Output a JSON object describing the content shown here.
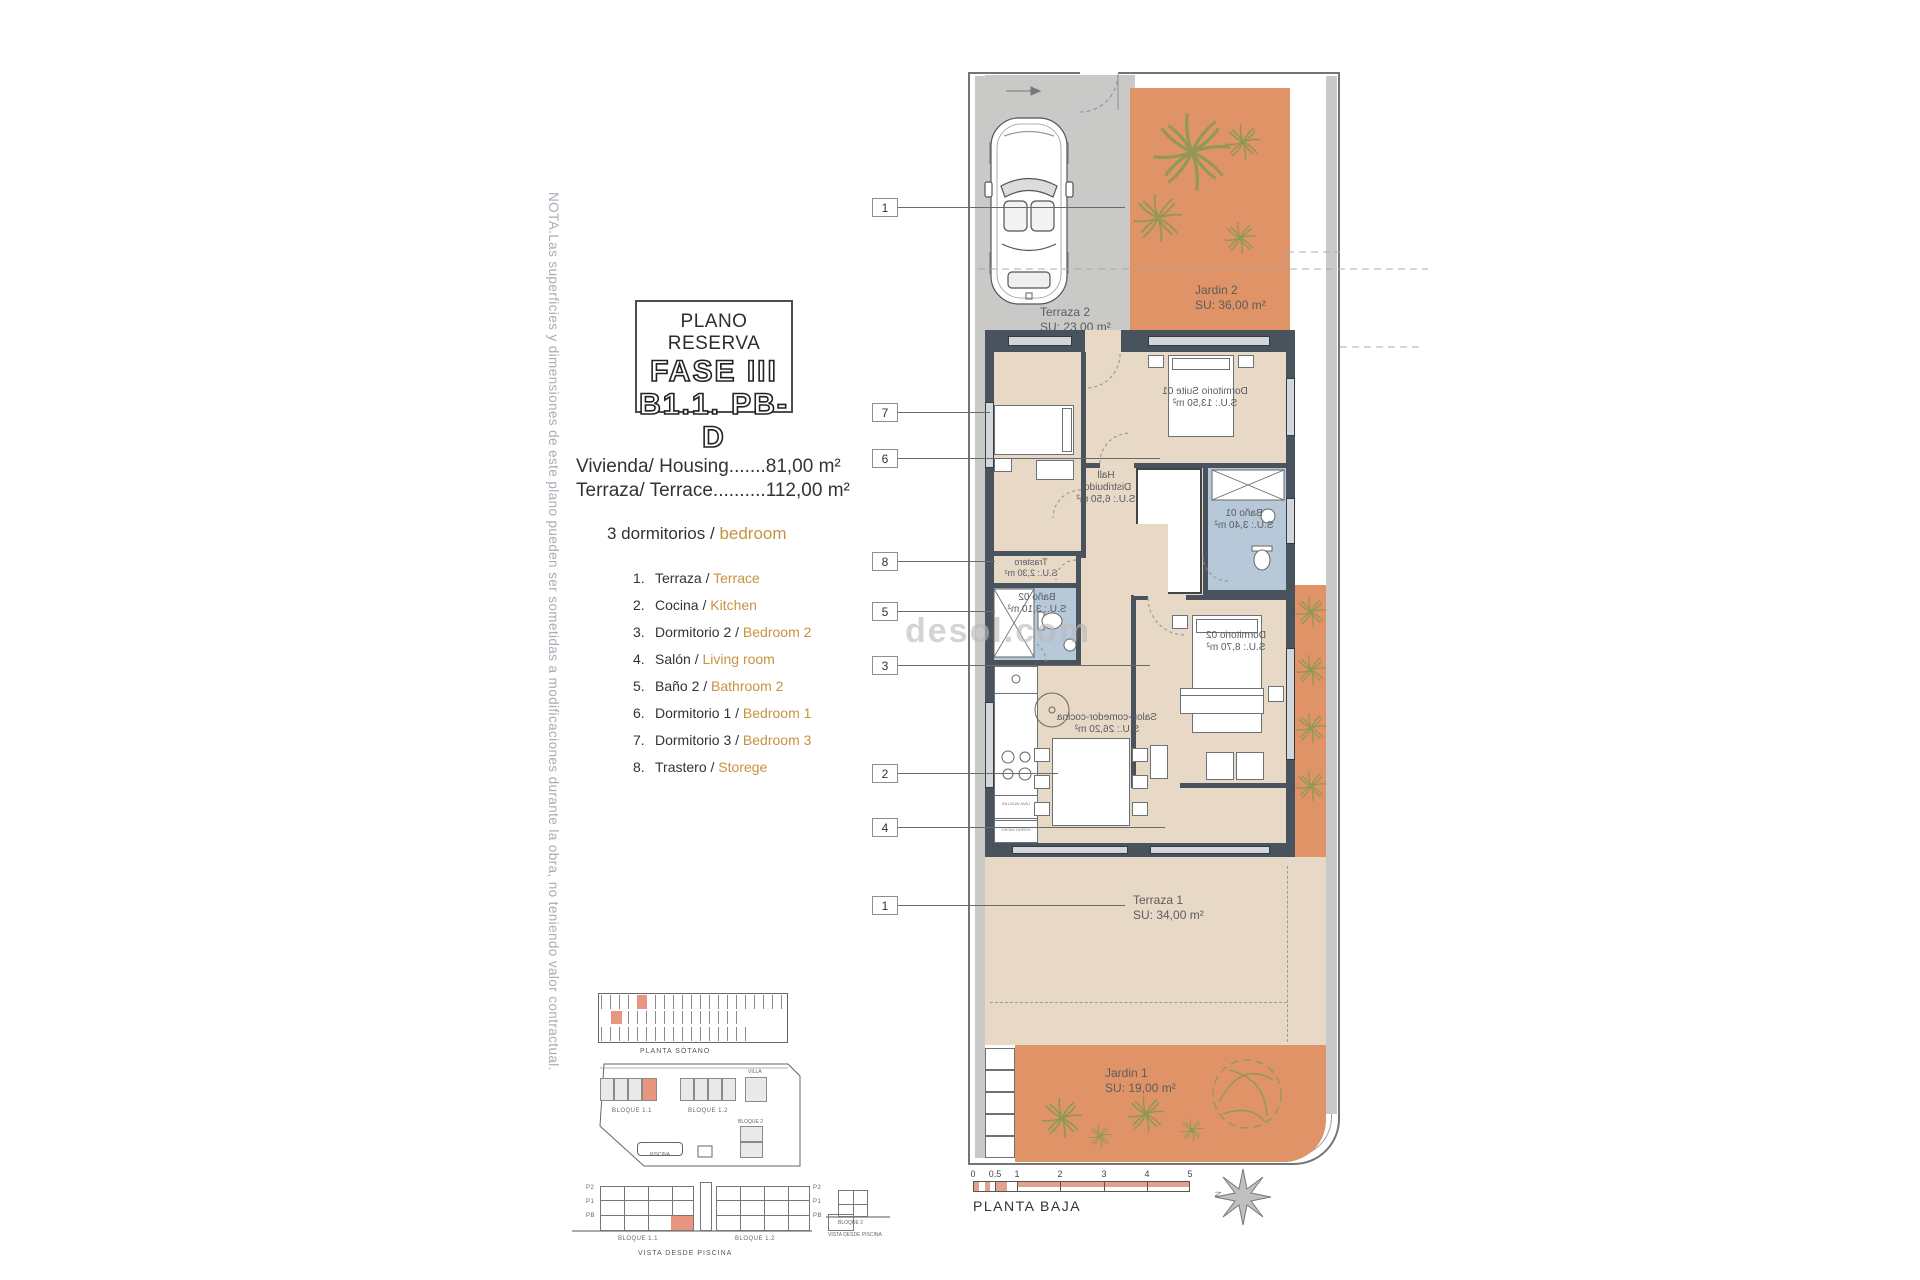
{
  "note": "NOTA.Las superficies y dimensiones de este plano pueden ser sometidas a modificaciones durante la obra, no teniendo valor contractual.",
  "title_block": {
    "line1": "PLANO RESERVA",
    "line2": "FASE III",
    "line3": "B1.1. PB-D"
  },
  "summary": {
    "housing": "Vivienda/ Housing.......81,00 m²",
    "terrace": "Terraza/ Terrace..........112,00 m²",
    "bedrooms_es": "3 dormitorios /",
    "bedrooms_en": "bedroom"
  },
  "legend": {
    "sep": "/",
    "items": [
      {
        "num": "1.",
        "es": "Terraza ",
        "en": " Terrace"
      },
      {
        "num": "2.",
        "es": "Cocina ",
        "en": " Kitchen"
      },
      {
        "num": "3.",
        "es": "Dormitorio 2 ",
        "en": " Bedroom 2"
      },
      {
        "num": "4.",
        "es": "Salón ",
        "en": " Living room"
      },
      {
        "num": "5.",
        "es": "Baño 2 ",
        "en": " Bathroom 2"
      },
      {
        "num": "6.",
        "es": "Dormitorio 1 ",
        "en": " Bedroom 1"
      },
      {
        "num": "7.",
        "es": "Dormitorio 3 ",
        "en": " Bedroom 3"
      },
      {
        "num": "8.",
        "es": "Trastero ",
        "en": " Storege"
      }
    ]
  },
  "callouts": [
    "1",
    "7",
    "6",
    "8",
    "5",
    "3",
    "2",
    "4",
    "1"
  ],
  "plan": {
    "rooms": {
      "terraza2": {
        "name": "Terraza 2",
        "area": "SU: 23,00 m²"
      },
      "jardin2": {
        "name": "Jardin 2",
        "area": "SU: 36,00 m²"
      },
      "suite": {
        "name": "Dormitorio Suite 01",
        "area": "S.U.: 13,50 m²"
      },
      "hall": {
        "l1": "Hall",
        "l2": "Distribuidor",
        "area": "S.U.: 6,50 m²"
      },
      "bano1": {
        "name": "Baño 01",
        "area": "S.U.: 3,40 m²"
      },
      "trastero": {
        "name": "Trastero",
        "area": "S.U.: 2,30 m²"
      },
      "bano2": {
        "name": "Baño 02",
        "area": "S.U.: 3,10 m²"
      },
      "dorm2": {
        "name": "Dormitorio 02",
        "area": "S.U.: 8,70 m²"
      },
      "salon": {
        "name": "Salon-comedor-cocina",
        "area": "S.U.: 26,20 m²"
      },
      "terraza1": {
        "name": "Terraza 1",
        "area": "SU: 34,00 m²"
      },
      "jardin1": {
        "name": "Jardin 1",
        "area": "SU: 19,00 m²"
      }
    },
    "kitchen": {
      "box1": "LAVA VAJILLAS",
      "box2": "HORNO MICRO"
    }
  },
  "watermark": "desol.com",
  "site": {
    "parking_label": "PLANTA SÓTANO",
    "bloque11": "BLOQUE 1.1",
    "bloque12": "BLOQUE 1.2",
    "bloque2": "BLOQUE 2",
    "villa": "VILLA",
    "piscina": "PISCINA",
    "vista": "VISTA DESDE PISCINA",
    "floors": [
      "P2",
      "P1",
      "PB"
    ]
  },
  "scale": {
    "ticks": [
      "0",
      "0.5",
      "1",
      "2",
      "3",
      "4",
      "5"
    ],
    "label": "PLANTA BAJA",
    "north": "N"
  },
  "colors": {
    "garden": "#df9367",
    "terrace": "#e8d8c6",
    "wall": "#49535e",
    "bath": "#b7c9d9",
    "accent": "#c8923f",
    "highlight": "#e8967f"
  }
}
